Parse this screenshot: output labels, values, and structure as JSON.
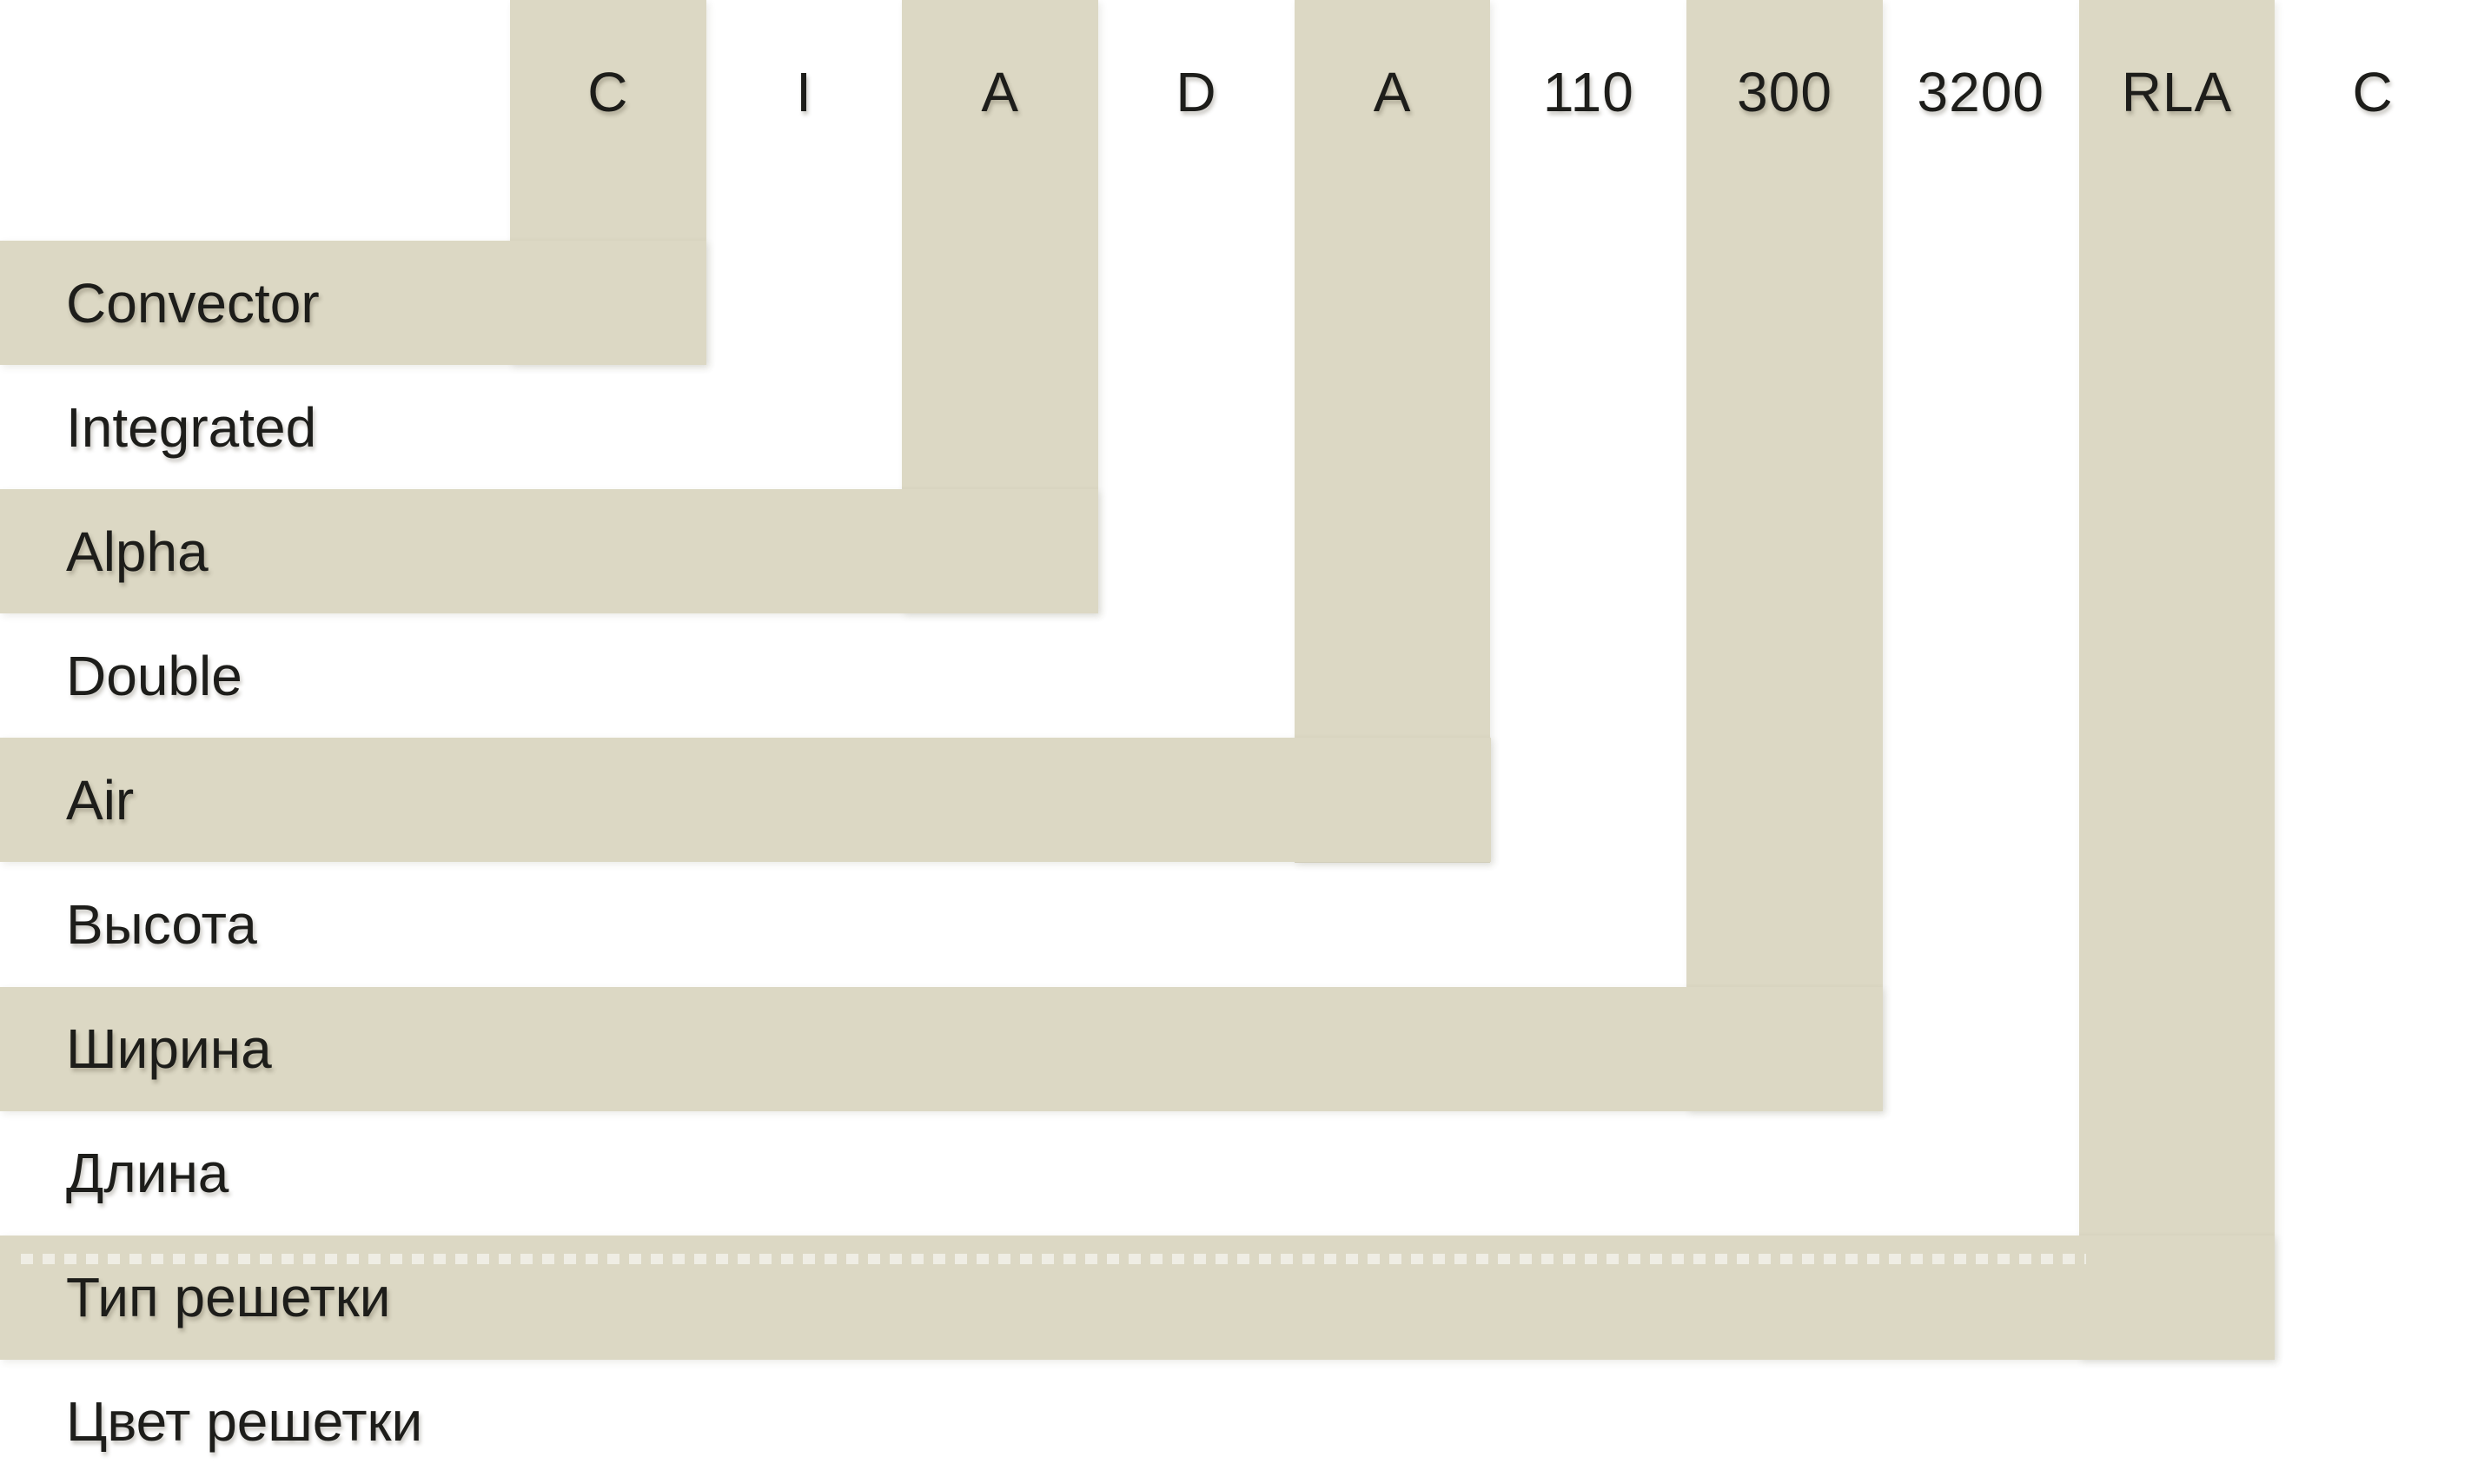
{
  "diagram": {
    "kind": "product-code-legend",
    "code_row": [
      "C",
      "I",
      "A",
      "D",
      "A",
      "110",
      "300",
      "3200",
      "RLA",
      "C"
    ]
  },
  "segments": [
    {
      "code": "C",
      "label": "Convector",
      "band": true,
      "dotted_line": false
    },
    {
      "code": "I",
      "label": "Integrated",
      "band": false,
      "dotted_line": false
    },
    {
      "code": "A",
      "label": "Alpha",
      "band": true,
      "dotted_line": false
    },
    {
      "code": "D",
      "label": "Double",
      "band": false,
      "dotted_line": false
    },
    {
      "code": "A",
      "label": "Air",
      "band": true,
      "dotted_line": false
    },
    {
      "code": "110",
      "label": "Высота",
      "band": false,
      "dotted_line": false
    },
    {
      "code": "300",
      "label": "Ширина",
      "band": true,
      "dotted_line": false
    },
    {
      "code": "3200",
      "label": "Длина",
      "band": false,
      "dotted_line": false
    },
    {
      "code": "RLA",
      "label": "Тип решетки",
      "band": true,
      "dotted_line": true
    },
    {
      "code": "C",
      "label": "Цвет решетки",
      "band": false,
      "dotted_line": false
    }
  ],
  "colors": {
    "band": "#dcd8c4",
    "background": "#ffffff",
    "text": "#1d1d1a",
    "dash": "rgba(255,255,255,0.55)"
  }
}
